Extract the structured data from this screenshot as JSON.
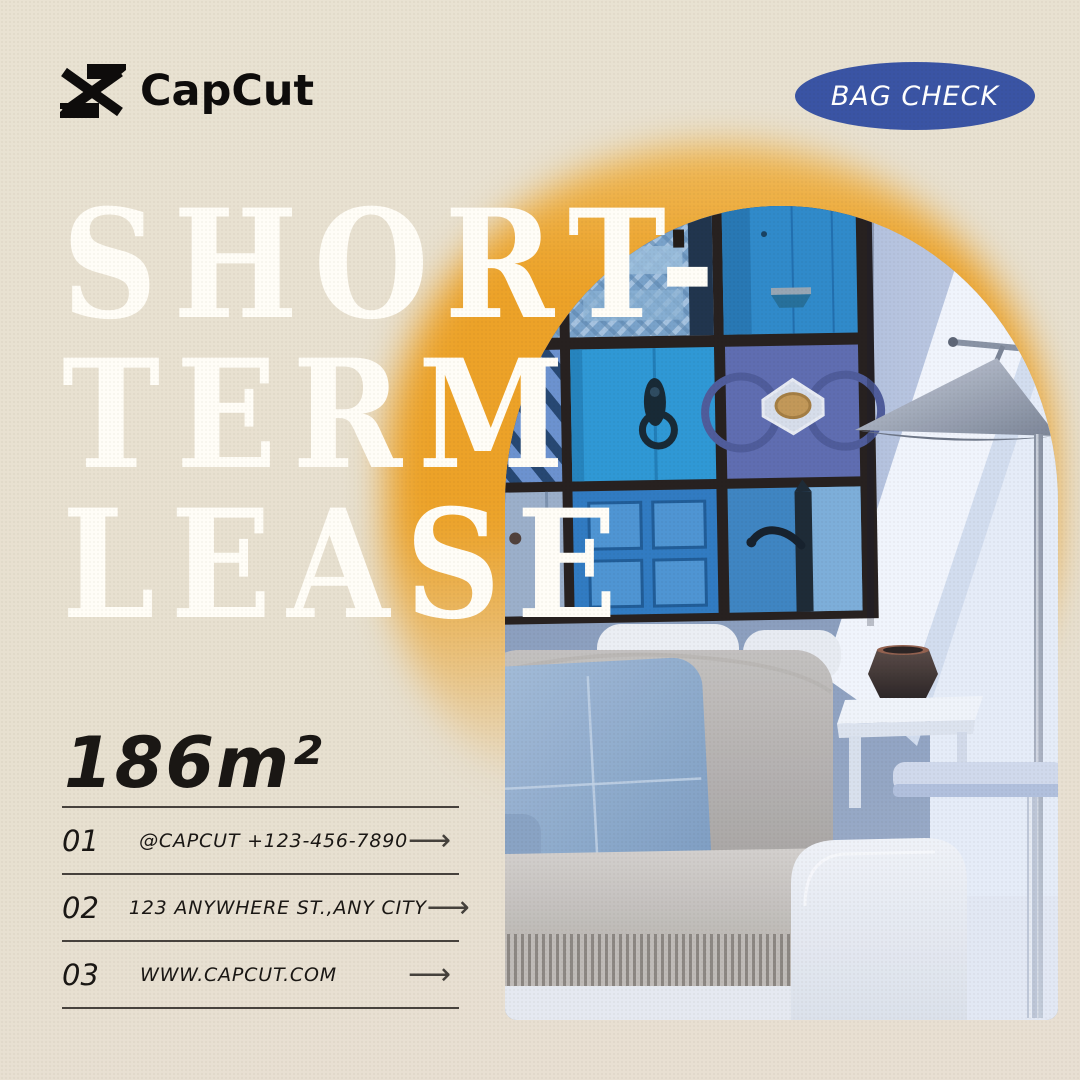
{
  "brand": {
    "name": "CapCut"
  },
  "badge": {
    "label": "BAG CHECK"
  },
  "hero": {
    "title_lines": [
      "SHORT-",
      "TERM",
      "LEASE"
    ]
  },
  "area": {
    "value": "186m²"
  },
  "contacts": {
    "arrow_glyph": "⟶",
    "items": [
      {
        "index": "01",
        "text": "@CAPCUT  +123-456-7890"
      },
      {
        "index": "02",
        "text": "123 ANYWHERE ST.,ANY CITY"
      },
      {
        "index": "03",
        "text": "WWW.CAPCUT.COM"
      }
    ]
  },
  "colors": {
    "background": "#e8e1d1",
    "badge_blue": "#3a54a4",
    "accent_orange": "#eca228",
    "title_white": "#fffdf7",
    "text_dark": "#1a1714",
    "line_dark": "#47423d"
  }
}
